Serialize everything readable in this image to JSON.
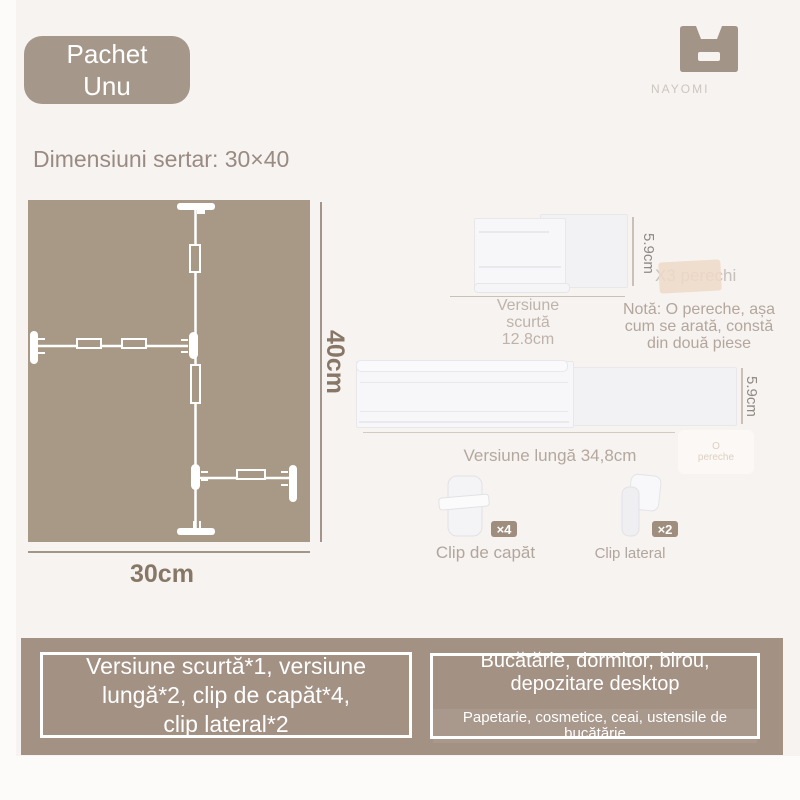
{
  "badge": {
    "label": "Pachet\nUnu"
  },
  "brand": {
    "name": "NAYOMI",
    "icon": "drawer-box-icon"
  },
  "heading": {
    "text": "Dimensiuni sertar: 30×40"
  },
  "diagram": {
    "width_label": "30cm",
    "height_label": "40cm",
    "fill_color": "#a89886",
    "divider_color": "#ffffff"
  },
  "short_version": {
    "height_label": "5.9cm",
    "caption": "Versiune\nscurtă\n12.8cm"
  },
  "sticker": {
    "text": "X3 perechi",
    "color": "#eedac7"
  },
  "note": {
    "text": "Notă: O pereche, așa\ncum se arată, constă\ndin două piese"
  },
  "long_version": {
    "height_label": "5.9cm",
    "caption": "Versiune lungă 34,8cm",
    "watermark": "O\npereche"
  },
  "clips": {
    "end_clip": {
      "label": "Clip de capăt",
      "count": "×4"
    },
    "side_clip": {
      "label": "Clip lateral",
      "count": "×2"
    }
  },
  "footer": {
    "contents_box": {
      "text": "Versiune scurtă*1, versiune\nlungă*2, clip de capăt*4,\nclip lateral*2"
    },
    "usage_box": {
      "title": "Bucătărie, dormitor, birou,\ndepozitare desktop",
      "subtitle": "Papetarie, cosmetice, ceai, ustensile de bucătărie"
    }
  },
  "colors": {
    "background": "#f7f3f0",
    "taupe_accent": "#a5988a",
    "footer_band": "#a39184",
    "count_badge": "#9f8e7e",
    "muted_text": "#b4a89e",
    "dim_text": "#877767",
    "white": "#ffffff"
  }
}
